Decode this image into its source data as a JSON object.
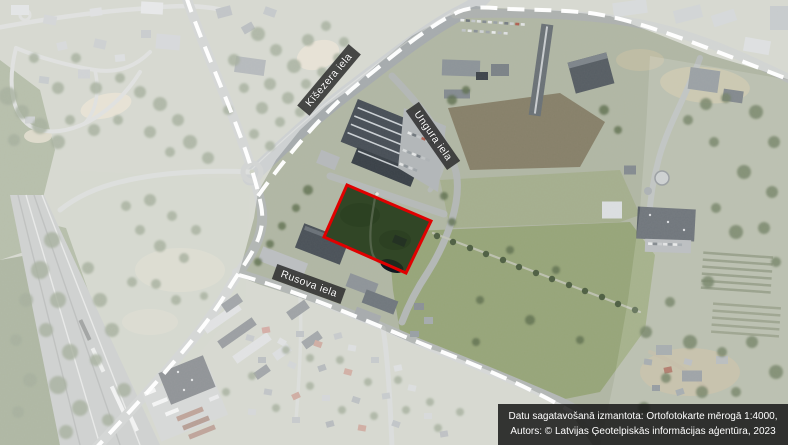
{
  "map": {
    "type": "orthophoto-plan-extract",
    "street_labels": [
      {
        "id": "kisezera",
        "text": "Kīšezera iela"
      },
      {
        "id": "ungura",
        "text": "Ungura iela"
      },
      {
        "id": "rusova",
        "text": "Rusova iela"
      }
    ],
    "credits": {
      "line1": "Datu sagatavošanā izmantota: Ortofotokarte mērogā 1:4000,",
      "line2": "Autors: © Latvijas Ģeotelpiskās informācijas aģentūra, 2023"
    },
    "parcel": {
      "points": "347,185 431,221 406,273 324,237",
      "outline_color": "#e00000"
    },
    "boundary": {
      "dash_color": "#ffffff",
      "west_path": "M 186,-4 C 205,55 248,140 261,205 C 268,240 244,262 228,290 C 205,330 152,388 96,448",
      "north_path": "M 258,196 C 280,165 320,115 358,84 C 390,58 425,28 458,12 C 475,5 490,8 510,9 C 540,10 560,10 590,13 C 640,20 700,45 790,80",
      "south_path": "M 239,275 C 300,292 360,318 420,343 C 470,363 520,382 572,412"
    },
    "overlay": {
      "territory_points": "258,192 276,160 300,130 326,106 352,88 380,62 412,36 440,20 458,12 476,6 492,8 520,9 560,11 610,16 660,35 710,55 760,70 790,80 790,447 594,447 566,406 530,389 492,372 452,356 412,343 372,325 332,309 292,295 258,284 238,276 246,248 254,218",
      "wash_d": "M -2,-2 L 790,-2 L 790,447 L -2,447 Z M 258,192 L 276,160 L 300,130 L 326,106 L 352,88 L 380,62 L 412,36 L 440,20 L 458,12 L 476,6 L 492,8 L 520,9 L 560,11 L 610,16 L 660,35 L 710,55 L 760,70 L 790,80 L 790,447 L 594,447 L 566,406 L 530,389 L 492,372 L 452,356 L 412,343 L 372,325 L 332,309 L 292,295 L 258,284 L 238,276 L 246,248 L 254,218 Z",
      "east_wash_points": "650,56 790,80 790,447 600,447 614,380 628,300 640,210 646,130"
    },
    "colors": {
      "label_bg": "rgba(45,45,45,0.85)",
      "label_text": "#ffffff",
      "credits_bg": "rgba(22,22,22,0.85)",
      "credits_text": "#ffffff",
      "wash": "#ffffff"
    }
  }
}
